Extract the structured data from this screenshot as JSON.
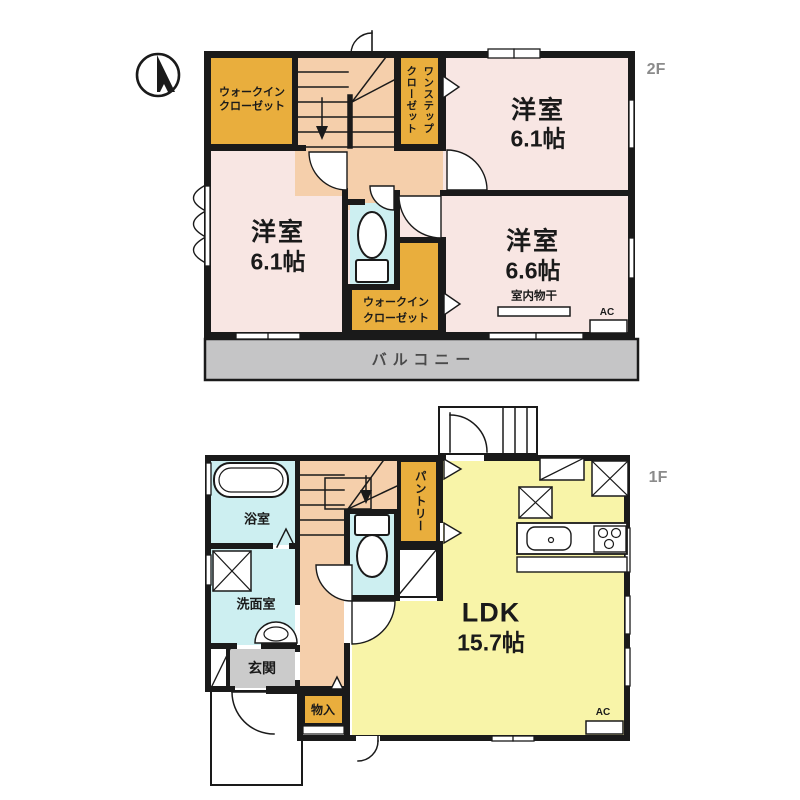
{
  "colors": {
    "wall": "#1a1a1a",
    "room_pink": "#f8e6e3",
    "closet_orange": "#e9ae3d",
    "hall_peach": "#f5cfab",
    "wet_blue": "#cdeff1",
    "ldk_yellow": "#f8f4a8",
    "balcony_gray": "#c5c5c6",
    "entry_gray": "#cbcbcb",
    "floor_label_gray": "#8b8b8b"
  },
  "floor2": {
    "floor_label": "2F",
    "walk_in_closet_top": [
      "ウォークイン",
      "クローゼット"
    ],
    "one_step_closet": [
      "ワンステップ",
      "クローゼット"
    ],
    "bedroom_top_right": {
      "name": "洋室",
      "size": "6.1帖"
    },
    "bedroom_left": {
      "name": "洋室",
      "size": "6.1帖"
    },
    "bedroom_bottom_right": {
      "name": "洋室",
      "size": "6.6帖"
    },
    "indoor_drying": "室内物干",
    "walk_in_closet_bottom": [
      "ウォークイン",
      "クローゼット"
    ],
    "ac_label": "AC",
    "balcony": "バルコニー"
  },
  "floor1": {
    "floor_label": "1F",
    "bathroom": "浴室",
    "washroom": "洗面室",
    "entrance": "玄関",
    "storage": "物入",
    "pantry": "パントリー",
    "ldk": {
      "name": "LDK",
      "size": "15.7帖"
    },
    "ac_label": "AC"
  }
}
